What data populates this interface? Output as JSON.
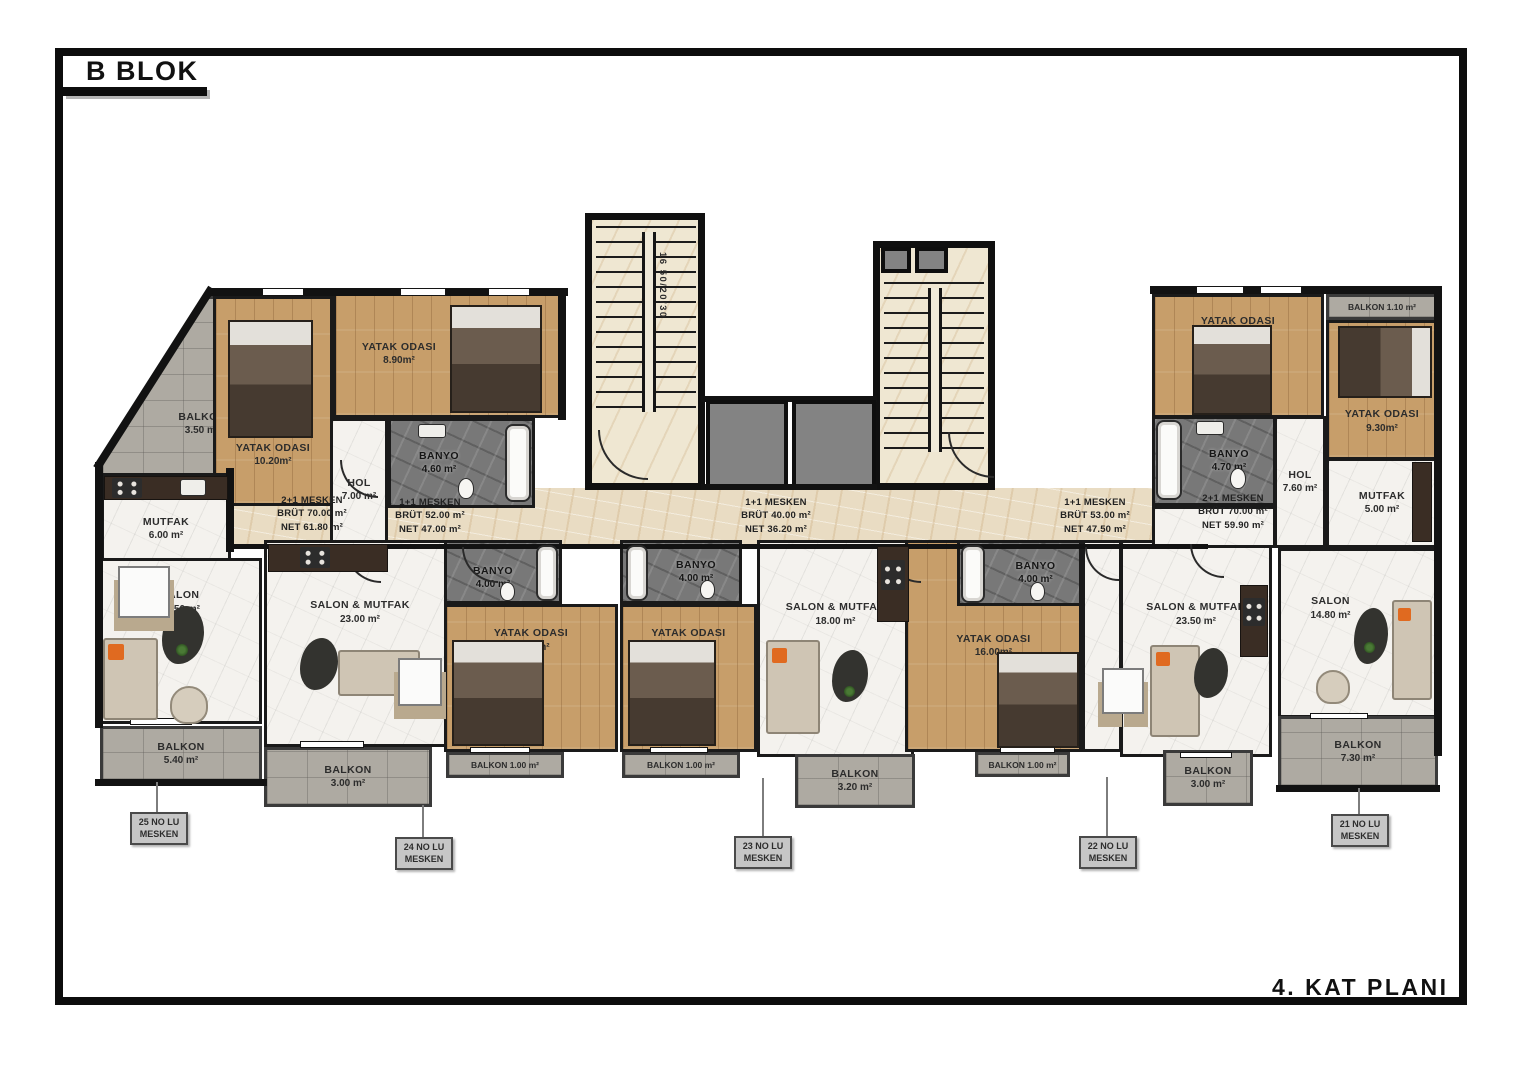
{
  "title": "B BLOK",
  "plan_label": "4. KAT PLANI",
  "stairwell": {
    "dimension_note": "16 50/20/30"
  },
  "colors": {
    "wall": "#121212",
    "wood_floor": "#c79e6a",
    "marble_floor": "#f4f2ee",
    "bath_floor": "#787878",
    "balcony_floor": "#aeaaa2",
    "corridor_floor": "#e9dcc3",
    "callout_bg": "#c6c6c6",
    "accent_orange": "#e06a20"
  },
  "apartments": {
    "a25": {
      "unit": {
        "line1": "2+1 MESKEN",
        "line2": "BRÜT 70.00 m²",
        "line3": "NET 61.80 m²"
      },
      "callout": {
        "line1": "25 NO LU",
        "line2": "MESKEN"
      },
      "rooms": {
        "balkon_nw": {
          "name": "BALKON",
          "area": "3.50 m²"
        },
        "yatak1": {
          "name": "YATAK ODASI",
          "area": "10.20m²"
        },
        "yatak2": {
          "name": "YATAK ODASI",
          "area": "8.90m²"
        },
        "banyo": {
          "name": "BANYO",
          "area": "4.60 m²"
        },
        "hol": {
          "name": "HOL",
          "area": "7.00 m²"
        },
        "mutfak": {
          "name": "MUTFAK",
          "area": "6.00 m²"
        },
        "salon": {
          "name": "SALON",
          "area": "14.50 m²"
        },
        "balkon_sw": {
          "name": "BALKON",
          "area": "5.40 m²"
        }
      }
    },
    "a24": {
      "unit": {
        "line1": "1+1 MESKEN",
        "line2": "BRÜT 52.00 m²",
        "line3": "NET 47.00 m²"
      },
      "callout": {
        "line1": "24 NO LU",
        "line2": "MESKEN"
      },
      "rooms": {
        "salon_mutfak": {
          "name": "SALON & MUTFAK",
          "area": "23.00 m²"
        },
        "banyo": {
          "name": "BANYO",
          "area": "4.00 m²"
        },
        "yatak": {
          "name": "YATAK ODASI",
          "area": "16.00m²"
        },
        "balkon_small": {
          "label": "BALKON 1.00 m²"
        },
        "balkon": {
          "name": "BALKON",
          "area": "3.00 m²"
        }
      }
    },
    "a23": {
      "unit": {
        "line1": "1+1 MESKEN",
        "line2": "BRÜT 40.00 m²",
        "line3": "NET 36.20 m²"
      },
      "callout": {
        "line1": "23 NO LU",
        "line2": "MESKEN"
      },
      "rooms": {
        "banyo": {
          "name": "BANYO",
          "area": "4.00 m²"
        },
        "yatak": {
          "name": "YATAK ODASI",
          "area": "10.00m²"
        },
        "salon_mutfak": {
          "name": "SALON & MUTFAK",
          "area": "18.00 m²"
        },
        "balkon_small": {
          "label": "BALKON 1.00 m²"
        },
        "balkon": {
          "name": "BALKON",
          "area": "3.20 m²"
        }
      }
    },
    "a22": {
      "unit": {
        "line1": "1+1 MESKEN",
        "line2": "BRÜT 53.00 m²",
        "line3": "NET 47.50 m²"
      },
      "callout": {
        "line1": "22 NO LU",
        "line2": "MESKEN"
      },
      "rooms": {
        "banyo": {
          "name": "BANYO",
          "area": "4.00 m²"
        },
        "yatak": {
          "name": "YATAK ODASI",
          "area": "16.00m²"
        },
        "salon_mutfak": {
          "name": "SALON & MUTFAK",
          "area": "23.50 m²"
        },
        "balkon_small": {
          "label": "BALKON 1.00 m²"
        },
        "balkon": {
          "name": "BALKON",
          "area": "3.00 m²"
        }
      }
    },
    "a21": {
      "unit": {
        "line1": "2+1 MESKEN",
        "line2": "BRÜT 70.00 m²",
        "line3": "NET 59.90 m²"
      },
      "callout": {
        "line1": "21 NO LU",
        "line2": "MESKEN"
      },
      "rooms": {
        "yatak1": {
          "name": "YATAK ODASI",
          "area": "10.10m²"
        },
        "balkon_small": {
          "label": "BALKON 1.10 m²"
        },
        "yatak2": {
          "name": "YATAK ODASI",
          "area": "9.30m²"
        },
        "banyo": {
          "name": "BANYO",
          "area": "4.70 m²"
        },
        "hol": {
          "name": "HOL",
          "area": "7.60 m²"
        },
        "mutfak": {
          "name": "MUTFAK",
          "area": "5.00 m²"
        },
        "salon": {
          "name": "SALON",
          "area": "14.80 m²"
        },
        "balkon": {
          "name": "BALKON",
          "area": "7.30 m²"
        }
      }
    }
  }
}
